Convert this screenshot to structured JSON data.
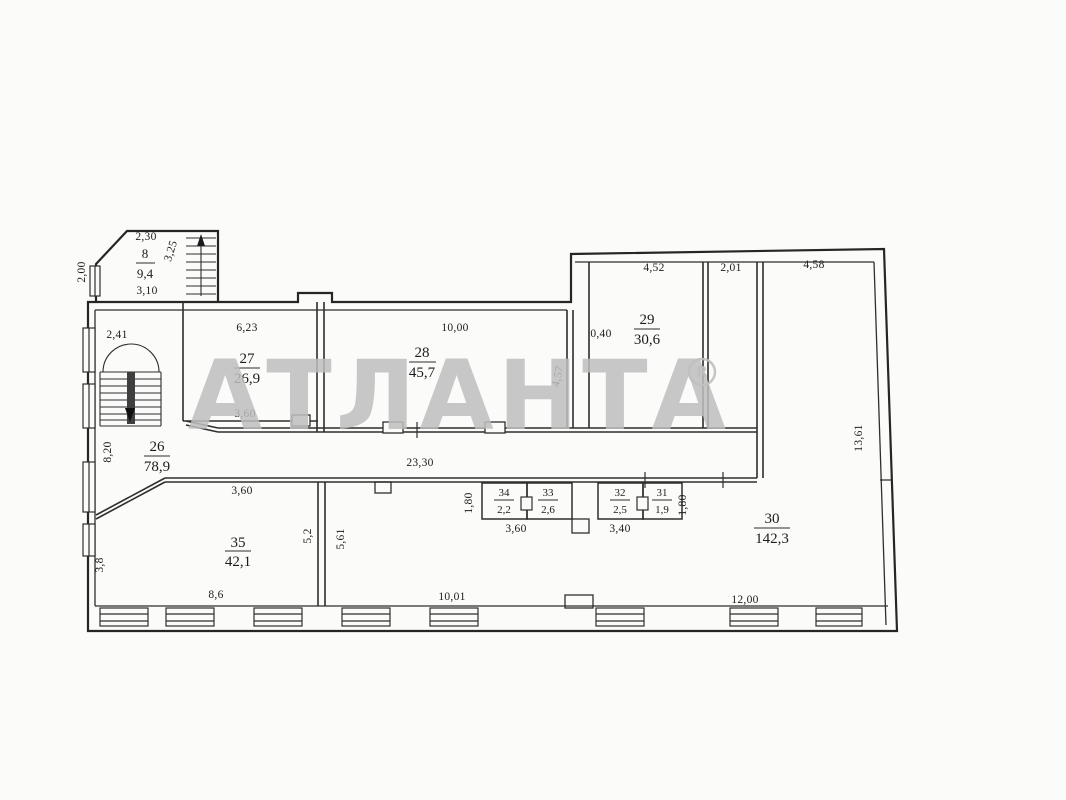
{
  "title": "Commercial floor plan scan",
  "watermark": {
    "text": "АТЛАНТА",
    "mark_letter": "R",
    "color": "#bfbfbf"
  },
  "rooms": [
    {
      "number": "8",
      "area": "9,4"
    },
    {
      "number": "26",
      "area": "78,9"
    },
    {
      "number": "27",
      "area": "26,9"
    },
    {
      "number": "28",
      "area": "45,7"
    },
    {
      "number": "29",
      "area": "30,6"
    },
    {
      "number": "30",
      "area": "142,3"
    },
    {
      "number": "31",
      "area": "1,9"
    },
    {
      "number": "32",
      "area": "2,5"
    },
    {
      "number": "33",
      "area": "2,6"
    },
    {
      "number": "34",
      "area": "2,2"
    },
    {
      "number": "35",
      "area": "42,1"
    }
  ],
  "dims": {
    "annex_top": "2,30",
    "annex_side": "3,25",
    "annex_left": "2,00",
    "annex_bottom": "3,10",
    "stair_hall_top": "2,41",
    "hall_left": "8,20",
    "room27_top": "6,23",
    "room27_bottom": "3,60",
    "room28_top": "10,00",
    "room28_right": "4,57",
    "room29_offset": "0,40",
    "room29_top": "4,52",
    "shaft_top": "2,01",
    "room30_top": "4,58",
    "room30_right": "13,61",
    "corridor": "23,30",
    "funnel_bottom": "3,60",
    "closets_left_height": "1,80",
    "closets_left_width": "3,60",
    "closets_right_width": "3,40",
    "closets_right_height": "1,80",
    "room35_left": "3,8",
    "room35_right": "5,2",
    "room35_bottom": "8,6",
    "open_left_height": "5,61",
    "open_bottom_left": "10,01",
    "open_bottom_right": "12,00"
  }
}
